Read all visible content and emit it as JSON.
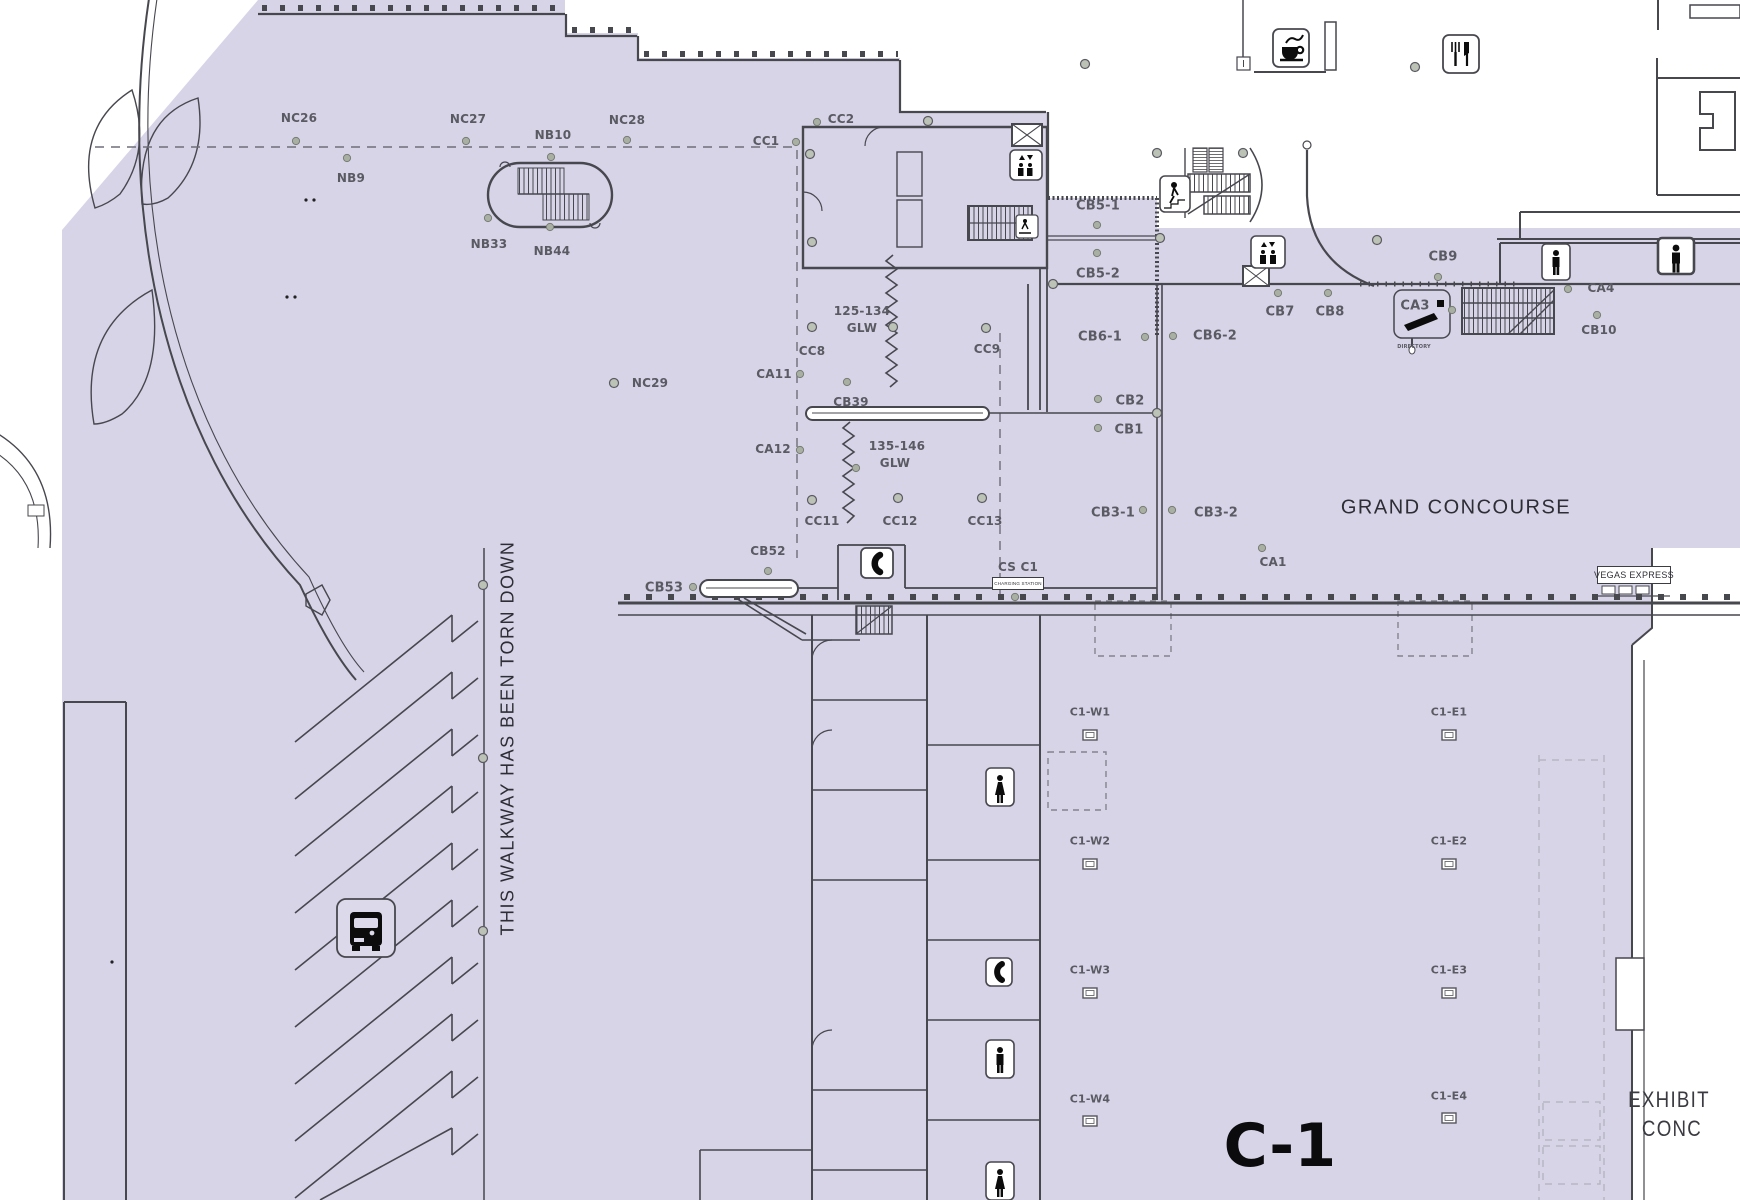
{
  "map": {
    "hall_id": "C-1",
    "concourse_name": "GRAND CONCOURSE",
    "colors": {
      "floor_fill": "#d7d4e8",
      "wall_ink": "#47474e",
      "label_gray": "#5a5a62",
      "dashed_gray": "#6e6e78",
      "marker_green": "#a9b0a3"
    },
    "signs": {
      "vegas_express": "VEGAS EXPRESS",
      "charging_station": "CHARGING STATION",
      "directory": "DIRECTORY",
      "walkway_notice": "THIS WALKWAY HAS BEEN TORN DOWN"
    },
    "icons": [
      "coffee-icon",
      "restaurant-icon",
      "elevator-icon",
      "elevator-shaft-icon",
      "stairs-icon",
      "stairs-up-icon",
      "escalator-icon",
      "mens-restroom-icon",
      "womens-restroom-icon",
      "phone-icon",
      "bus-icon",
      "directory-kiosk-icon",
      "column-marker-icon"
    ]
  },
  "map_labels": [
    {
      "t": "NC26",
      "x": 299,
      "y": 118
    },
    {
      "t": "NC27",
      "x": 468,
      "y": 119
    },
    {
      "t": "NC28",
      "x": 627,
      "y": 120
    },
    {
      "t": "NB10",
      "x": 553,
      "y": 135
    },
    {
      "t": "NB9",
      "x": 351,
      "y": 178
    },
    {
      "t": "NB33",
      "x": 489,
      "y": 244
    },
    {
      "t": "NB44",
      "x": 552,
      "y": 251
    },
    {
      "t": "NC29",
      "x": 650,
      "y": 383
    },
    {
      "t": "CC1",
      "x": 766,
      "y": 141
    },
    {
      "t": "CC2",
      "x": 841,
      "y": 119
    },
    {
      "t": "CB5-1",
      "x": 1098,
      "y": 206,
      "fs": 13
    },
    {
      "t": "CB5-2",
      "x": 1098,
      "y": 274,
      "fs": 13
    },
    {
      "t": "CB7",
      "x": 1280,
      "y": 312,
      "fs": 13
    },
    {
      "t": "CB8",
      "x": 1330,
      "y": 312,
      "fs": 13
    },
    {
      "t": "CB9",
      "x": 1443,
      "y": 257,
      "fs": 13
    },
    {
      "t": "CB6-1",
      "x": 1100,
      "y": 337,
      "fs": 13
    },
    {
      "t": "CB6-2",
      "x": 1215,
      "y": 336,
      "fs": 13
    },
    {
      "t": "CB2",
      "x": 1130,
      "y": 401,
      "fs": 13
    },
    {
      "t": "CB1",
      "x": 1129,
      "y": 430,
      "fs": 13
    },
    {
      "t": "CB3-1",
      "x": 1113,
      "y": 513,
      "fs": 13
    },
    {
      "t": "CB3-2",
      "x": 1216,
      "y": 513,
      "fs": 13
    },
    {
      "t": "CC8",
      "x": 812,
      "y": 351
    },
    {
      "t": "CC9",
      "x": 987,
      "y": 349
    },
    {
      "t": "CA11",
      "x": 774,
      "y": 374
    },
    {
      "t": "CA12",
      "x": 773,
      "y": 449
    },
    {
      "t": "CB39",
      "x": 851,
      "y": 402
    },
    {
      "t": "CC11",
      "x": 822,
      "y": 521
    },
    {
      "t": "CC12",
      "x": 900,
      "y": 521
    },
    {
      "t": "CC13",
      "x": 985,
      "y": 521
    },
    {
      "t": "125-134",
      "x": 862,
      "y": 311
    },
    {
      "t": "GLW",
      "x": 862,
      "y": 328
    },
    {
      "t": "135-146",
      "x": 897,
      "y": 446
    },
    {
      "t": "GLW",
      "x": 895,
      "y": 463
    },
    {
      "t": "CB52",
      "x": 768,
      "y": 551
    },
    {
      "t": "CB53",
      "x": 664,
      "y": 588,
      "fs": 13
    },
    {
      "t": "CS C1",
      "x": 1018,
      "y": 567
    },
    {
      "t": "CA1",
      "x": 1273,
      "y": 562
    },
    {
      "t": "CA3",
      "x": 1415,
      "y": 306,
      "fs": 13
    },
    {
      "t": "DIRECTORY",
      "x": 1414,
      "y": 347,
      "fs": 5
    },
    {
      "t": "CA4",
      "x": 1601,
      "y": 288
    },
    {
      "t": "CB10",
      "x": 1599,
      "y": 330
    },
    {
      "t": "GRAND CONCOURSE",
      "x": 1456,
      "y": 508,
      "fs": 20,
      "v": "display",
      "color": "#2d2d34"
    },
    {
      "t": "C1-W1",
      "x": 1090,
      "y": 712,
      "fs": 11
    },
    {
      "t": "C1-W2",
      "x": 1090,
      "y": 841,
      "fs": 11
    },
    {
      "t": "C1-W3",
      "x": 1090,
      "y": 970,
      "fs": 11
    },
    {
      "t": "C1-W4",
      "x": 1090,
      "y": 1099,
      "fs": 11
    },
    {
      "t": "C1-E1",
      "x": 1449,
      "y": 712,
      "fs": 11
    },
    {
      "t": "C1-E2",
      "x": 1449,
      "y": 841,
      "fs": 11
    },
    {
      "t": "C1-E3",
      "x": 1449,
      "y": 970,
      "fs": 11
    },
    {
      "t": "C1-E4",
      "x": 1449,
      "y": 1096,
      "fs": 11
    },
    {
      "t": "C-1",
      "x": 1280,
      "y": 1146,
      "fs": 60,
      "fw": 800,
      "color": "#0b0b0d"
    },
    {
      "t": "EXHIBIT",
      "x": 1669,
      "y": 1100,
      "fs": 22,
      "v": "display",
      "color": "#3a3a41",
      "sx": 0.85
    },
    {
      "t": "CONC",
      "x": 1672,
      "y": 1129,
      "fs": 22,
      "v": "display",
      "color": "#3a3a41",
      "sx": 0.85
    },
    {
      "t": "THIS WALKWAY HAS BEEN TORN DOWN",
      "x": 508,
      "y": 738,
      "fs": 18,
      "v": "display",
      "color": "#2d2d34",
      "rot": -90
    }
  ]
}
